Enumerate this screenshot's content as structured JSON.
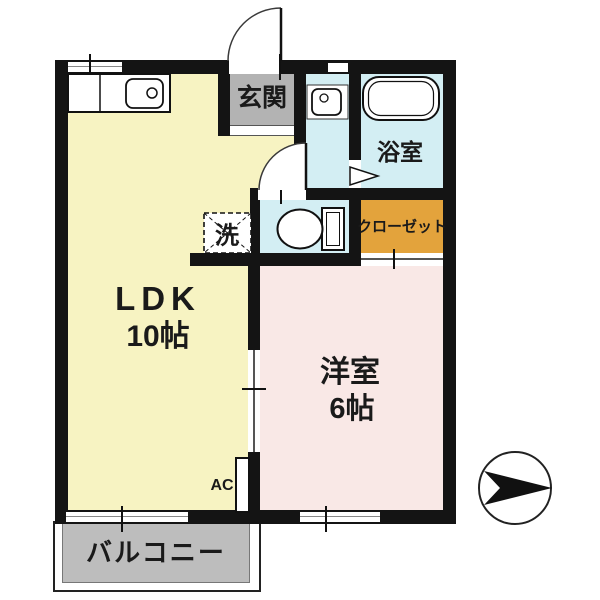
{
  "plan": {
    "rooms": {
      "ldk": {
        "name": "LDK",
        "size": "10帖"
      },
      "western_room": {
        "name": "洋室",
        "size": "6帖"
      },
      "entrance": {
        "name": "玄関"
      },
      "bathroom": {
        "name": "浴室"
      },
      "laundry": {
        "name": "洗"
      },
      "closet": {
        "name": "クローゼット"
      },
      "balcony": {
        "name": "バルコニー"
      }
    },
    "labels": {
      "air_conditioner": "AC"
    },
    "compass": {
      "arrow_points": "right"
    }
  },
  "colors": {
    "wall": "#141414",
    "ldk": "#f7f3c2",
    "western_room": "#f9e8e6",
    "wet_area": "#d3eef3",
    "closet": "#e3a33c",
    "genkan": "#b3b3b3",
    "balcony": "#bdbdbd",
    "text": "#1a1a1a"
  }
}
